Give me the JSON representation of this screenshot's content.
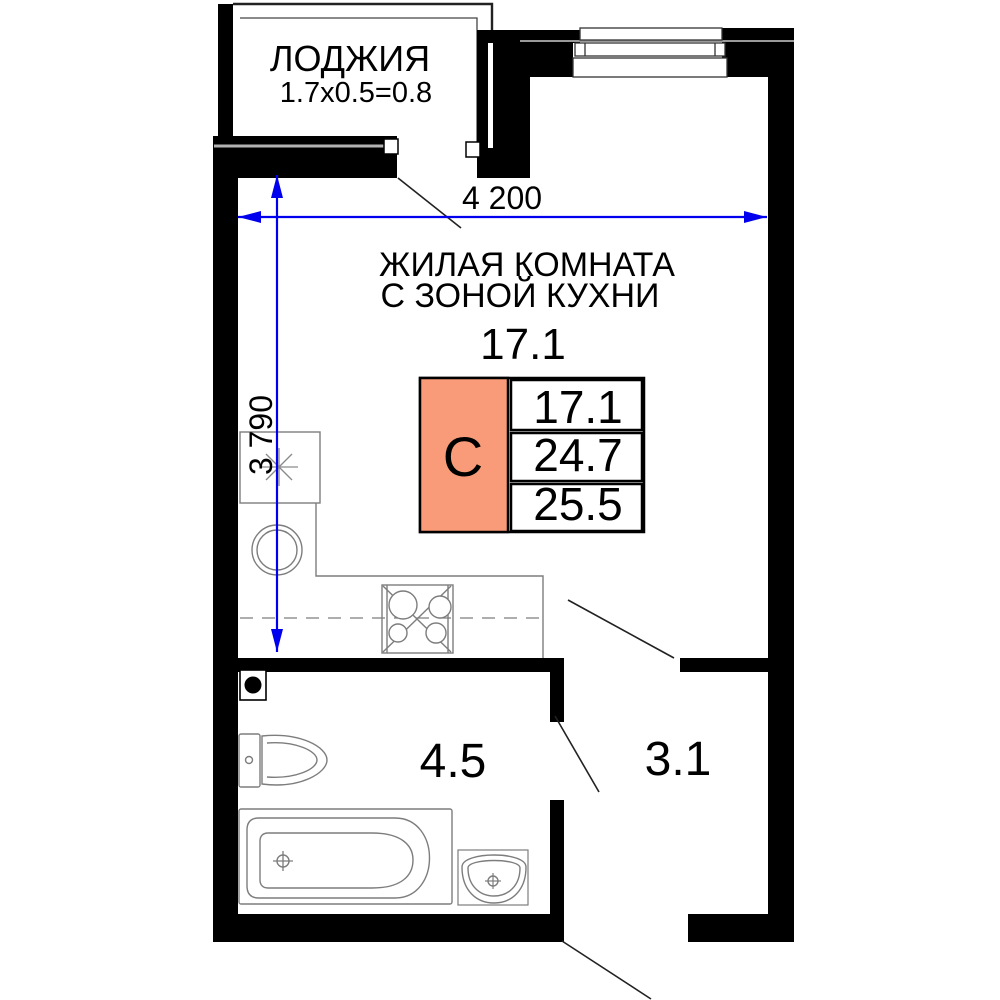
{
  "plan": {
    "loggia": {
      "label": "ЛОДЖИЯ",
      "formula": "1.7x0.5=0.8"
    },
    "living_room": {
      "name_line1": "ЖИЛАЯ КОМНАТА",
      "name_line2": "С ЗОНОЙ КУХНИ",
      "area": "17.1"
    },
    "legend": {
      "letter": "С",
      "values": [
        "17.1",
        "24.7",
        "25.5"
      ]
    },
    "dimensions": {
      "horizontal": "4 200",
      "vertical": "3 790"
    },
    "bathroom": {
      "area": "4.5"
    },
    "hall": {
      "area": "3.1"
    },
    "colors": {
      "wall": "#000000",
      "dimension": "#0000ee",
      "legend_fill": "#f99b78",
      "fixture": "#7d7d7d"
    }
  }
}
